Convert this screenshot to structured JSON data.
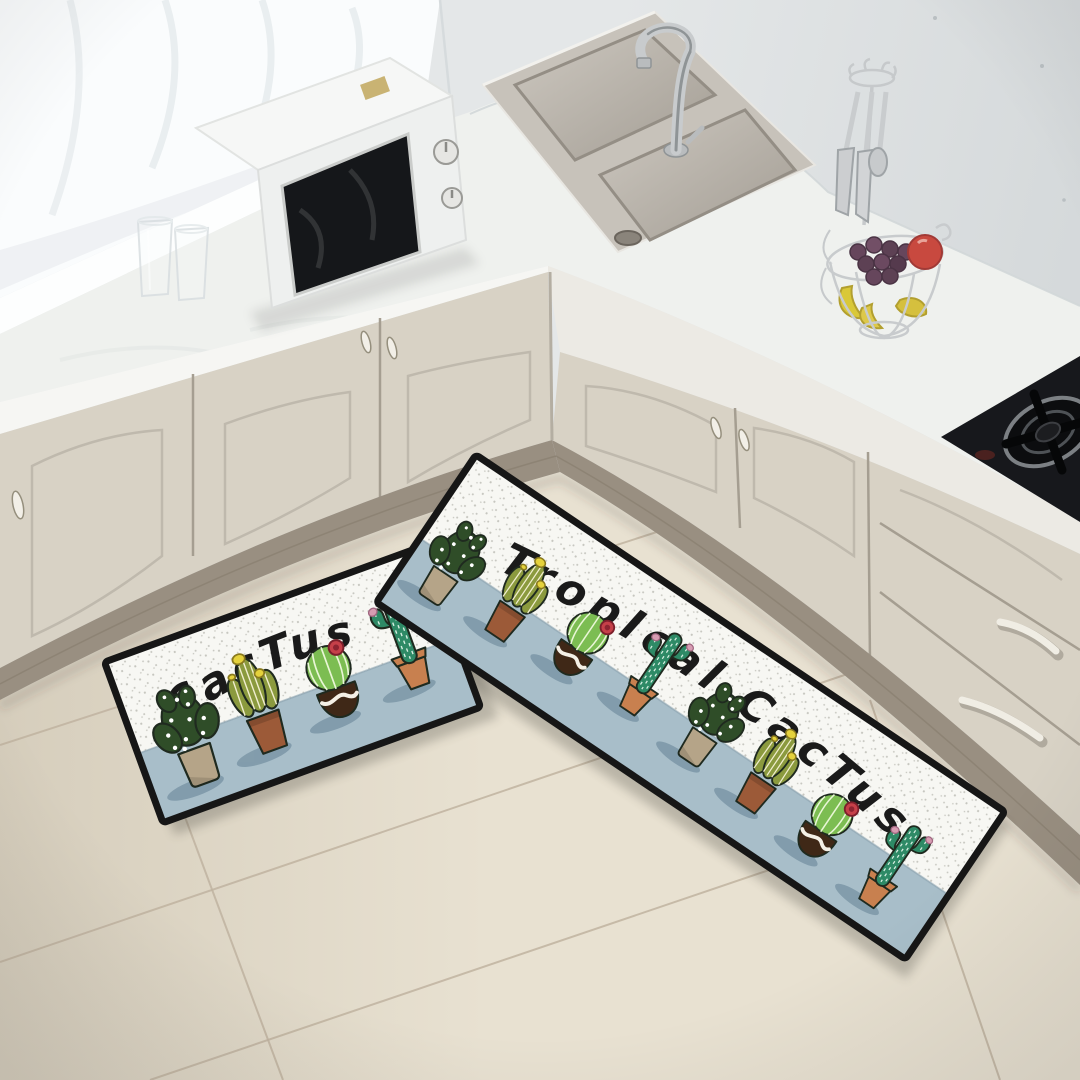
{
  "scene": {
    "setting": "kitchen corner photo",
    "objects": [
      "window-curtain",
      "windowsill",
      "l-shaped-countertop",
      "cream-cabinet-doors",
      "double-stainless-sink",
      "gooseneck-faucet",
      "white-microwave-oven",
      "drinking-glasses",
      "hanging-utensil-stand",
      "wire-fruit-basket",
      "grapes",
      "bananas",
      "apple",
      "black-gas-cooktop",
      "beige-tile-floor",
      "cactus-kitchen-floor-mats"
    ]
  },
  "mats": {
    "small": {
      "label": "CacTus",
      "cacti": [
        "dotted-prickly-pear",
        "olive-barrel-cluster",
        "striped-ball-red-bloom",
        "teal-saguaro"
      ]
    },
    "large": {
      "label": "TropIcal CacTus",
      "cacti": [
        "dotted-prickly-pear",
        "olive-barrel-cluster",
        "striped-ball-red-bloom",
        "teal-saguaro",
        "dotted-prickly-pear",
        "olive-barrel-cluster",
        "striped-ball-red-bloom",
        "teal-saguaro"
      ]
    }
  },
  "palette": {
    "wall": "#e4e7e8",
    "curtain": "#fafcfd",
    "counter_top": "#eff1ee",
    "cabinet_face": "#d8d2c5",
    "plinth_wood": "#998f81",
    "floor": "#e8e1d1",
    "grout": "#bfb3a0",
    "mat_border": "#161616",
    "mat_blue": "#a8bec9",
    "mat_speckle_bg": "#f7f7f3",
    "mat_speckle_dot": "#c6c6bf",
    "mat_shadow": "#7e99a9",
    "mat_text": "#1a1a1a",
    "cactus_dark": "#2f4d28",
    "cactus_olive": "#8b9a3e",
    "cactus_bright": "#7cbd52",
    "cactus_teal": "#2e8a66",
    "pot_tan": "#b5a488",
    "pot_terracotta": "#9c5a38",
    "pot_darkbrown": "#3f2817",
    "pot_clay": "#c8804f",
    "flower_yellow": "#e5d23c",
    "flower_red": "#c64049",
    "flower_pink": "#d79cb2",
    "outline": "#1f2a1f",
    "steel": "#c6c9cb",
    "stove_black": "#17181c"
  }
}
